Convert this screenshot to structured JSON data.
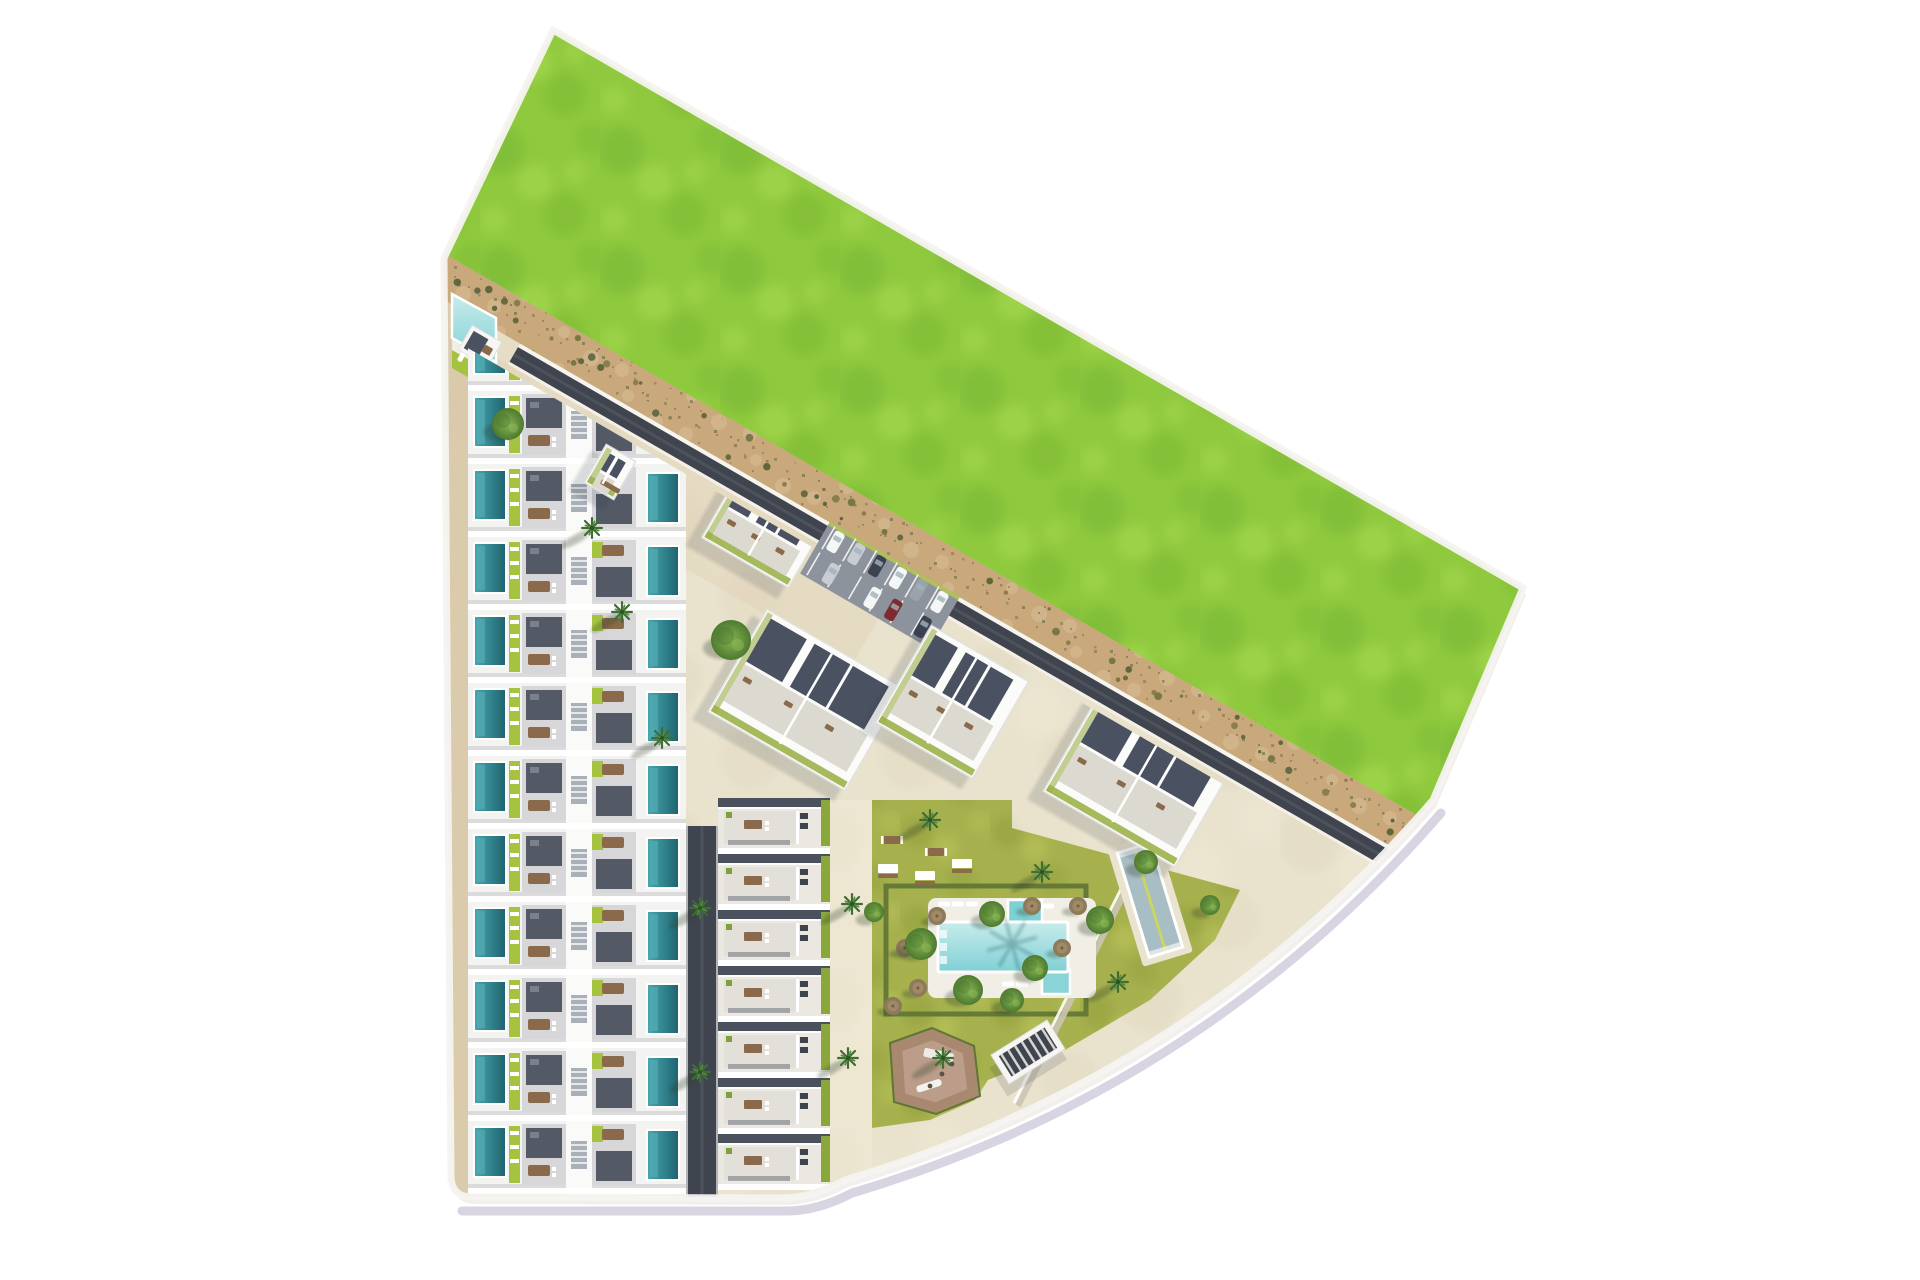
{
  "meta": {
    "description": "aerial-3d-site-plan-residential-development",
    "canvas": {
      "w": 1920,
      "h": 1280
    }
  },
  "palette": {
    "bg": "#ffffff",
    "grass_base": "#8fc93e",
    "grass_dark": "#79b734",
    "grass_light": "#a5d84e",
    "grass_edge": "#6fa82e",
    "sand_base": "#c9a87c",
    "sand_dark": "#8d7a52",
    "sand_olive": "#6a6d42",
    "sand_light": "#dcc49b",
    "rim_white": "#f5f3f0",
    "curb": "#d8d4e2",
    "slab": "#f2efec",
    "floor": "#e9e2cd",
    "floor_dark": "#ded3b8",
    "floor_light": "#f1ebd8",
    "promenade": "#dfd0b5",
    "walkway": "#d8c7a7",
    "road_dark": "#3f444e",
    "road_mid": "#4d535d",
    "line_white": "#f6f4ef",
    "bldg_base": "#f3f3f1",
    "core_white": "#fafaf9",
    "roof_dark": "#535a66",
    "roof_vent": "#7a818d",
    "deck": "#d7d7da",
    "stair": "#a9b0b9",
    "stair_line": "#e6e8ea",
    "row_shadow": "#c6c6ca",
    "lime": "#a6c33f",
    "lounger": "#ffffff",
    "table_brown": "#8a6a4a",
    "pool_priv_hi": "#46a5ae",
    "pool_priv_lo": "#1f6570",
    "pool_sparkle": "#5cb3bb",
    "mid_base": "#eae8e1",
    "mid_roof": "#4a505c",
    "mid_terrace": "#e3e0d9",
    "mid_court": "#555b66",
    "hedge_lime": "#8aa73c",
    "ac_unit": "#3e444e",
    "planter": "#7fa03a",
    "block_white": "#fbfbf9",
    "block_roof": "#4a5160",
    "block_terrace": "#dcd9d1",
    "block_green": "#9cb14b",
    "block_edge": "#e1e1e1",
    "parking_asphalt": "#8d939c",
    "stall_line": "#ffffff",
    "curb_lime": "#b9cc4e",
    "car_colors": [
      "#f5f6f6",
      "#c9ccd2",
      "#3c4250",
      "#9aa2ab",
      "#7e2a2e"
    ],
    "garden_base": "#a6b14e",
    "garden_dark": "#93a03c",
    "garden_light": "#bac45a",
    "hedge_dark": "#5d7434",
    "pool_deck": "#f1eee6",
    "pool_hi": "#c9ecec",
    "pool_lo": "#7fd0d5",
    "kids_pool": "#7fd0d5",
    "jacuzzi": "#8ad4d8",
    "lap_deck": "#eae3cf",
    "lap_water": "#a9bdc4",
    "lap_lane": "#c9d75e",
    "pg_outer": "#a98872",
    "pg_inner": "#bb9d8a",
    "pergola_dark": "#3e4450",
    "pergola_frame": "#f7f6f3",
    "tree_light": "#86b353",
    "tree_dark": "#4d7a2f",
    "tree_blotch": "#436f2a",
    "tree_glint": "#9cc45c",
    "palm": "#3f6d33",
    "palm_light": "#558a3f",
    "palm_core": "#2c5526",
    "shrub_colors": [
      "#6b6f3f",
      "#55603a",
      "#7c7748",
      "#4e5c33"
    ],
    "shadow": "#2f3744",
    "shadow_green": "#2e4026",
    "wall_line": "#cbc5b4"
  },
  "geometry": {
    "angle_deg": 30,
    "anchor": [
      443,
      253
    ],
    "site_path": "M553 30 L1523 588 L1433 800 Q1194 1076 845 1180 Q812 1198 782 1198 L472 1197 Q452 1197 451 1177 L444 258 Z",
    "curb_path": "M1437 804 Q1198 1080 848 1184 Q814 1202 782 1202 L458 1202",
    "bands": {
      "green": [
        -700,
        0
      ],
      "sand": [
        0,
        40
      ],
      "speckle": [
        3,
        26
      ],
      "white1": [
        40,
        44
      ],
      "road": [
        44,
        61
      ],
      "road_center": [
        51,
        54
      ],
      "white2": [
        61,
        64
      ],
      "band_t": [
        -80,
        1300
      ],
      "road_t": [
        112,
        1240
      ],
      "dev_clip_o": 70,
      "promenade_o": [
        64,
        152
      ],
      "promenade_t": [
        0,
        560
      ]
    }
  },
  "townhouse_column": {
    "x": 468,
    "w": 218,
    "row_start": 318,
    "pitch": 73,
    "row_h": 67,
    "count": 12
  },
  "vertical_road": {
    "x": 686,
    "y": 826,
    "w": 32,
    "h": 371
  },
  "mid_column": {
    "x": 718,
    "w": 112,
    "row_start": 798,
    "pitch": 56,
    "row_h": 50,
    "count": 7
  },
  "left_walkway": {
    "x": 447,
    "y": 300,
    "w": 26,
    "h": 897
  },
  "mid_walkway_tint": {
    "x": 830,
    "y": 800,
    "w": 42,
    "h": 390
  },
  "blocks": [
    {
      "cx": 765,
      "cy": 528,
      "w": 100,
      "h": 80,
      "rot": 30
    },
    {
      "cx": 806,
      "cy": 700,
      "w": 158,
      "h": 118,
      "rot": 30
    },
    {
      "cx": 952,
      "cy": 702,
      "w": 112,
      "h": 112,
      "rot": 30
    },
    {
      "cx": 1138,
      "cy": 779,
      "w": 152,
      "h": 116,
      "rot": 30
    },
    {
      "cx": 610,
      "cy": 472,
      "w": 34,
      "h": 44,
      "rot": 30
    }
  ],
  "parking": {
    "cx": 880,
    "cy": 585,
    "w": 150,
    "h": 60,
    "rot": 30,
    "cars": [
      [
        -60,
        -1,
        0
      ],
      [
        -36,
        -1,
        1
      ],
      [
        -12,
        -1,
        2
      ],
      [
        12,
        -1,
        0
      ],
      [
        36,
        -1,
        3
      ],
      [
        60,
        -1,
        0
      ],
      [
        -48,
        1,
        1
      ],
      [
        0,
        1,
        0
      ],
      [
        24,
        1,
        4
      ],
      [
        58,
        1,
        2
      ]
    ],
    "stall_step": 24
  },
  "corner_pool": {
    "water": "452,294 496,318 496,362 452,338",
    "deck": "452,338 496,362 496,374 452,350",
    "lawn": "452,350 543,402 543,420 452,368",
    "loungers": [
      [
        462,
        356
      ],
      [
        476,
        364
      ],
      [
        490,
        372
      ],
      [
        504,
        380
      ]
    ],
    "cabana": {
      "cx": 480,
      "cy": 346,
      "w": 34,
      "h": 28,
      "rot": 30
    }
  },
  "garden": {
    "main_pts": [
      [
        872,
        800
      ],
      [
        1012,
        800
      ],
      [
        1012,
        828
      ],
      [
        1240,
        890
      ],
      [
        1215,
        940
      ],
      [
        1150,
        1000
      ],
      [
        1065,
        1050
      ],
      [
        988,
        1080
      ],
      [
        975,
        1100
      ],
      [
        930,
        1120
      ],
      [
        872,
        1128
      ]
    ],
    "hedge_rect": [
      886,
      886,
      200,
      128
    ],
    "benches": [
      [
        878,
        864
      ],
      [
        915,
        871
      ],
      [
        952,
        859
      ]
    ],
    "picnic_tables": [
      [
        884,
        836
      ],
      [
        928,
        848
      ]
    ],
    "parasols": [
      [
        905,
        948
      ],
      [
        918,
        988
      ],
      [
        937,
        916
      ],
      [
        1032,
        906
      ],
      [
        1062,
        948
      ],
      [
        1078,
        906
      ],
      [
        893,
        1006
      ]
    ],
    "terrace_walls": [
      [
        1160,
        822,
        1018,
        1106
      ],
      [
        1156,
        819,
        1014,
        1103
      ]
    ]
  },
  "pool_complex": {
    "deck": [
      928,
      898,
      168,
      100
    ],
    "main": [
      938,
      922,
      130,
      50
    ],
    "kids": [
      1008,
      900,
      34,
      24
    ],
    "jacuzzi": [
      1042,
      970,
      28,
      24
    ],
    "steps_x": 940,
    "loungers": [
      [
        944,
        904,
        0
      ],
      [
        958,
        904,
        0
      ],
      [
        972,
        904,
        0
      ],
      [
        1048,
        906,
        0
      ],
      [
        1008,
        984,
        0
      ],
      [
        1022,
        984,
        0
      ]
    ],
    "palm_shadow": [
      1012,
      944
    ]
  },
  "lap_pool": {
    "cx": 1150,
    "cy": 900,
    "w": 52,
    "h": 124,
    "rot": -17
  },
  "pergola": {
    "cx": 1028,
    "cy": 1052,
    "w": 66,
    "h": 34,
    "rot": -32
  },
  "playground": {
    "outer": [
      [
        890,
        1043
      ],
      [
        932,
        1028
      ],
      [
        974,
        1046
      ],
      [
        980,
        1096
      ],
      [
        936,
        1114
      ],
      [
        894,
        1102
      ]
    ],
    "cx": 934,
    "cy": 1072
  },
  "vegetation": {
    "round_trees": [
      [
        508,
        424,
        16
      ],
      [
        731,
        640,
        20
      ],
      [
        921,
        944,
        16
      ],
      [
        968,
        990,
        15
      ],
      [
        992,
        914,
        13
      ],
      [
        1035,
        968,
        13
      ],
      [
        1100,
        920,
        14
      ],
      [
        1012,
        1000,
        12
      ],
      [
        874,
        912,
        10
      ],
      [
        1146,
        862,
        12
      ],
      [
        1210,
        905,
        10
      ]
    ],
    "palms": [
      [
        622,
        612
      ],
      [
        662,
        738
      ],
      [
        700,
        1072
      ],
      [
        852,
        904
      ],
      [
        848,
        1058
      ],
      [
        943,
        1058
      ],
      [
        1042,
        872
      ],
      [
        1118,
        982
      ],
      [
        930,
        820
      ],
      [
        700,
        908
      ],
      [
        592,
        528
      ]
    ],
    "shrubs": {
      "count": 70,
      "seed": 11
    }
  }
}
